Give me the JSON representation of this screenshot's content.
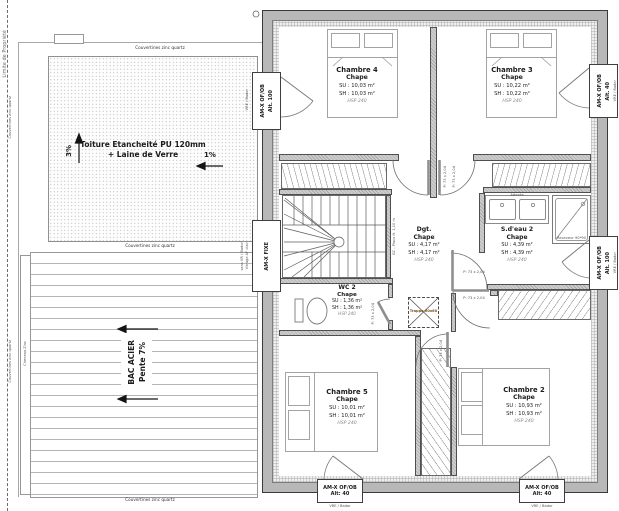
{
  "site": {
    "property_line_label": "Limite de Propriété",
    "coping_label": "Couvertines zinc quartz",
    "gutter_label": "Cheneau Zinc",
    "flat_roof_line1": "Toiture Etancheité PU 120mm",
    "flat_roof_line2": "+ Laine de Verre",
    "slope_up": "3%",
    "slope_left": "1%",
    "steel_roof_line1": "BAC ACIER",
    "steel_roof_line2": "Pente 7%"
  },
  "rooms": [
    {
      "name": "Chambre 4",
      "finish": "Chape",
      "su": "SU : 10,03 m²",
      "sh": "SH : 10,03 m²",
      "hsp": "HSP 240"
    },
    {
      "name": "Chambre 3",
      "finish": "Chape",
      "su": "SU : 10,22 m²",
      "sh": "SH : 10,22 m²",
      "hsp": "HSP 240"
    },
    {
      "name": "Dgt.",
      "finish": "Chape",
      "su": "SU : 4,17 m²",
      "sh": "SH : 4,17 m²",
      "hsp": "HSP 240"
    },
    {
      "name": "S.d'eau 2",
      "finish": "Chape",
      "su": "SU : 4,39 m²",
      "sh": "SH : 4,39 m²",
      "hsp": "HSP 240"
    },
    {
      "name": "WC 2",
      "finish": "Chape",
      "su": "SU : 1,36 m²",
      "sh": "SH : 1,36 m²",
      "hsp": "HSP 240"
    },
    {
      "name": "Chambre 5",
      "finish": "Chape",
      "su": "SU : 10,01 m²",
      "sh": "SH : 10,01 m²",
      "hsp": "HSP 240"
    },
    {
      "name": "Chambre 2",
      "finish": "Chape",
      "su": "SU : 10,93 m²",
      "sh": "SH : 10,93 m²",
      "hsp": "HSP 240"
    }
  ],
  "doors": {
    "label": "P: 73 x 2,04"
  },
  "windows": {
    "left_top": {
      "line1": "AM-X OF/OB",
      "line2": "Alt. 100"
    },
    "left_mid": {
      "line1": "AM-X FIXE"
    },
    "right_top": {
      "line1": "AM-X OF/OB",
      "line2": "Alt. 40"
    },
    "right_mid": {
      "line1": "AM-X OF/OB",
      "line2": "Alt. 100"
    },
    "bottom_left": {
      "line1": "AM-X OF/OB",
      "line2": "Alt: 40"
    },
    "bottom_right": {
      "line1": "AM-X OF/OB",
      "line2": "Alt: 40"
    },
    "shutter_note": "VRE / Bador",
    "fixed_note_line1": "sans VR / Bador",
    "fixed_note_line2": "Vitrage AF clair"
  },
  "annotations": {
    "guardrail": "GC - Placo H. 1,10 m",
    "hatch": "Trappe 60x60",
    "waiting": "Attente",
    "shower_tray": "Receveur 90*90"
  },
  "colors": {
    "wall": "#b8b8b8",
    "line": "#555555",
    "paper": "#ffffff"
  }
}
